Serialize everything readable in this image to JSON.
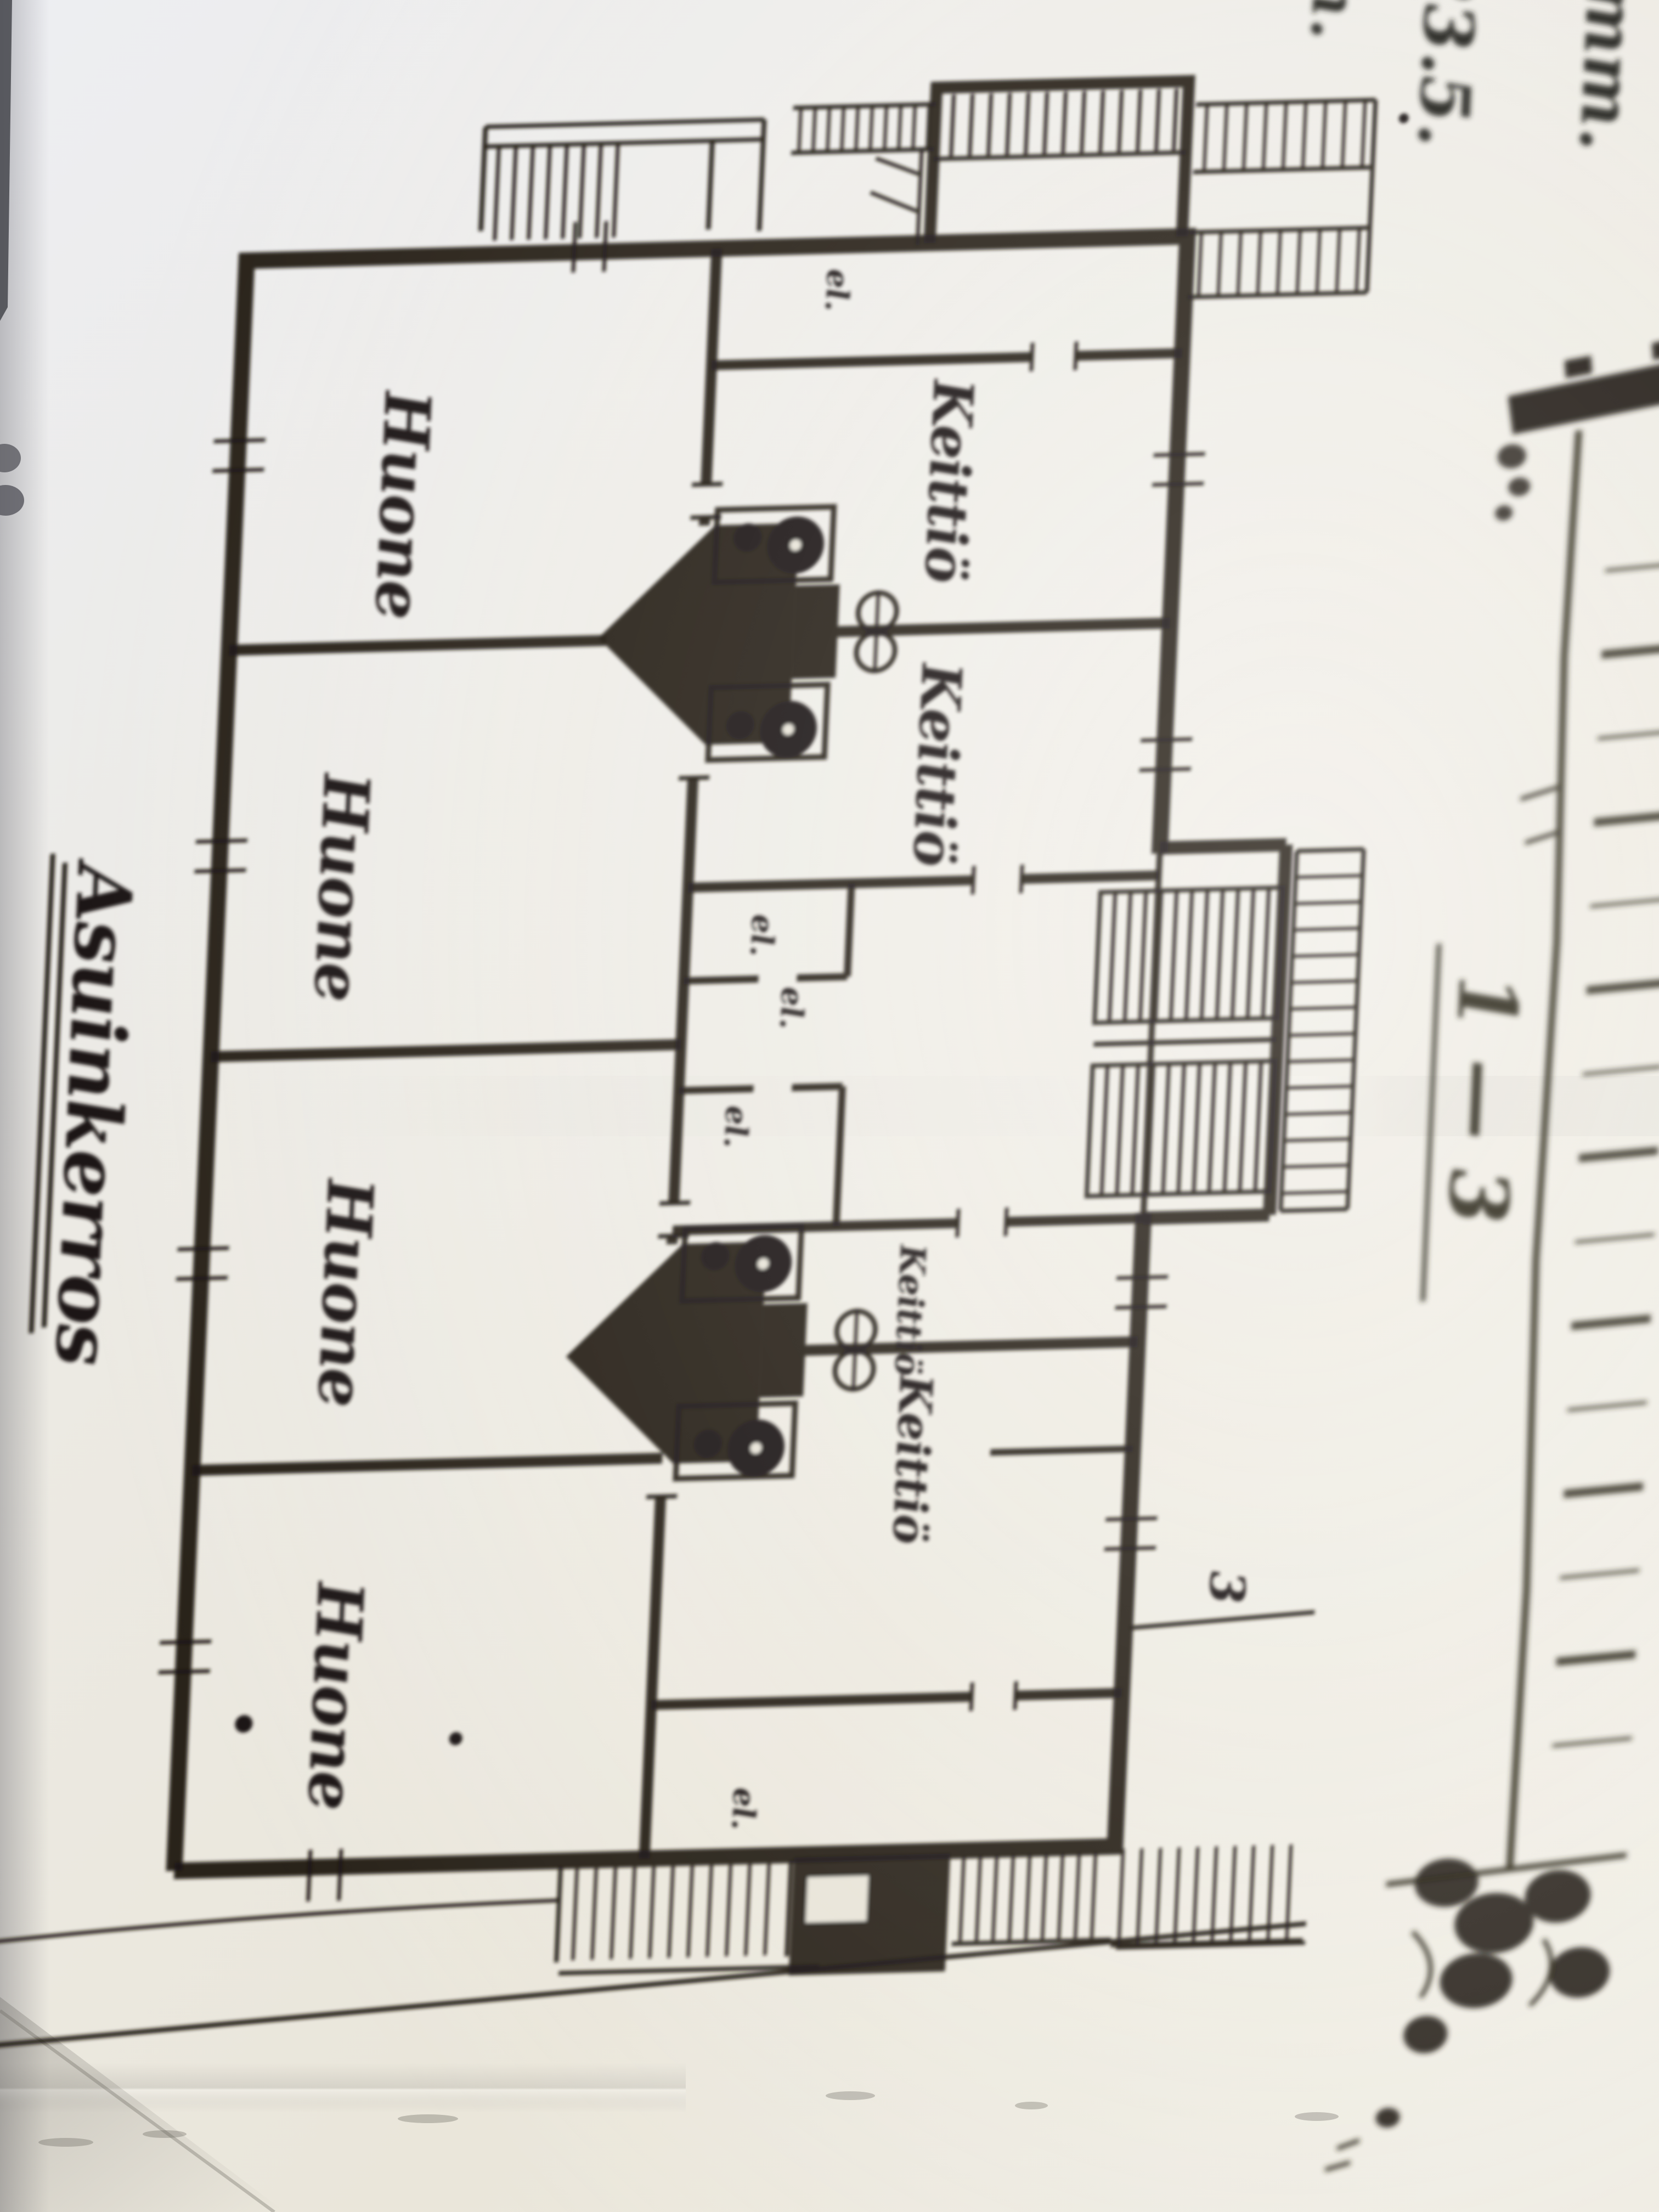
{
  "floor_plan_title": {
    "text": "Asuinkerros"
  },
  "floor_plan": {
    "rooms": [
      {
        "label": "Huone"
      },
      {
        "label": "Huone"
      },
      {
        "label": "Huone"
      },
      {
        "label": "Huone"
      }
    ],
    "kitchens": [
      {
        "label": "Keittiö"
      },
      {
        "label": "Keittiö"
      },
      {
        "label": "Keittiö"
      },
      {
        "label": "Keittiö"
      }
    ],
    "closet_labels": [
      {
        "text": "el."
      },
      {
        "text": "el."
      },
      {
        "text": "el."
      },
      {
        "text": "el."
      },
      {
        "text": "el."
      }
    ],
    "section_cut_marker": "3"
  },
  "section_view": {
    "label": "1 — 3"
  },
  "handwritten_fragments": [
    {
      "text": "th."
    },
    {
      "text": "23.5."
    },
    {
      "text": "4 mm."
    }
  ],
  "colors": {
    "ink": "#1c1712",
    "ink_soft": "#2f2a1b",
    "paper_cool": "#eceef1",
    "paper_warm": "#e9e5d9",
    "paper_bright": "#f3f2ed",
    "edge_dark": "#45464c"
  }
}
